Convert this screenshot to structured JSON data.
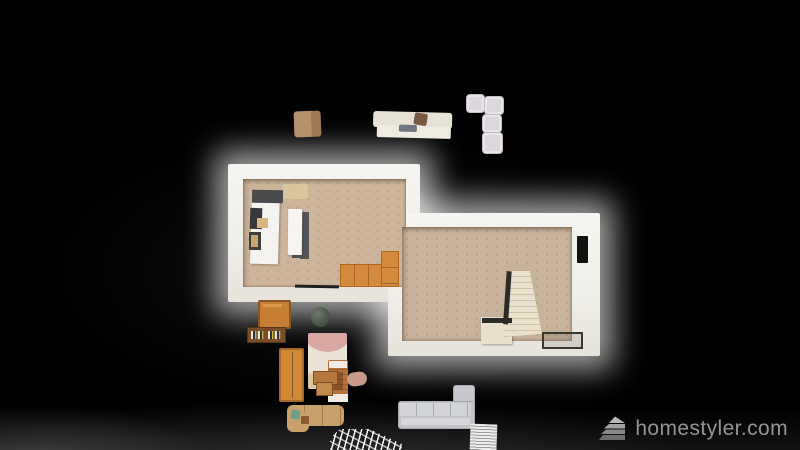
{
  "watermark": {
    "text": "homestyler.com",
    "color": "#949494",
    "icon": "homestyler-layers-logo"
  },
  "scene": {
    "view": "top-down 3d floor plan render",
    "background": "#000000",
    "glow_color": "#ffffff",
    "rooms": [
      {
        "name": "left-room",
        "role": "kitchen-living",
        "floor_color": "#cdb59b",
        "wall_color": "#f2efe9",
        "items": [
          "entry-mat",
          "kitchen-counter",
          "range-hood",
          "cooktop",
          "cutting-board",
          "sink",
          "kitchen-island",
          "l-shaped-orange-cabinet",
          "door-threshold"
        ]
      },
      {
        "name": "right-room",
        "role": "hall-with-stairs",
        "floor_color": "#c7b29c",
        "wall_color": "#f2efe9",
        "items": [
          "l-shaped-staircase",
          "stair-railing",
          "framed-floor-mat",
          "dark-door"
        ]
      }
    ],
    "unplaced_items": [
      {
        "name": "fabric-cube-chair",
        "color": "#b6906a"
      },
      {
        "name": "cream-sofa",
        "color": "#e7e2d6",
        "details": [
          "brown-pillow",
          "gray-blanket"
        ]
      },
      {
        "name": "modular-sofa-blocks",
        "color": "#dcd7dc",
        "count": 4
      },
      {
        "name": "wooden-cabinet",
        "color": "#c57e33"
      },
      {
        "name": "bookshelf-with-books",
        "color": "#7a4c27"
      },
      {
        "name": "potted-plant",
        "color": "#49544a"
      },
      {
        "name": "wardrobe",
        "color": "#d18836"
      },
      {
        "name": "abstract-area-rug",
        "colors": [
          "#d9a8a3",
          "#ece3d6",
          "#8fad9d",
          "#dcc9a4"
        ]
      },
      {
        "name": "wooden-bed",
        "color": "#a5672f"
      },
      {
        "name": "desk",
        "color": "#b5773c"
      },
      {
        "name": "stool",
        "color": "#c08a4a"
      },
      {
        "name": "pouf",
        "color": "#c79a8b"
      },
      {
        "name": "l-shaped-desk",
        "color": "#c7a06b",
        "details": [
          "teal-chair",
          "brown-box"
        ]
      },
      {
        "name": "white-grid-rug",
        "color": "#ffffff"
      },
      {
        "name": "gray-sectional-sofa",
        "color": "#c3c4c9"
      },
      {
        "name": "lined-panel",
        "color": "#ececec"
      }
    ]
  }
}
